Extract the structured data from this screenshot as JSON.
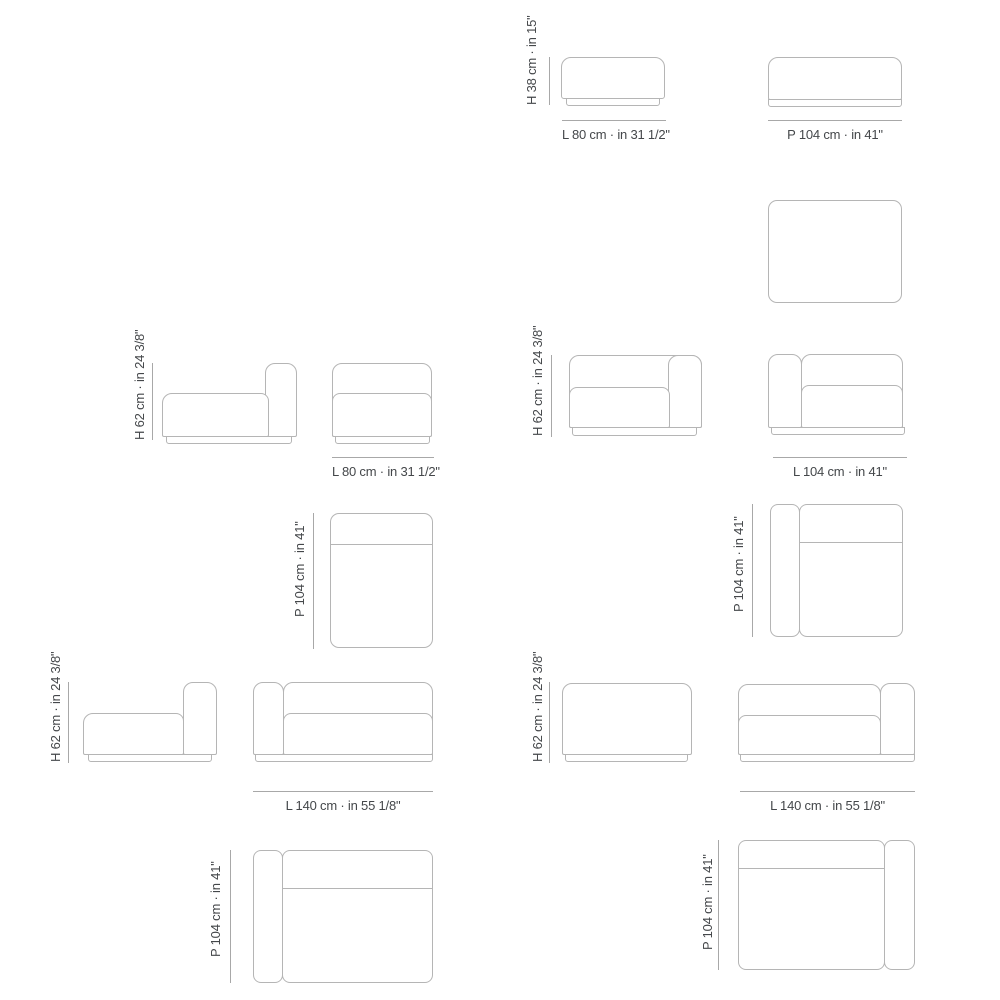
{
  "colors": {
    "background": "#ffffff",
    "drawing_line": "#b5b5b5",
    "dimension_line": "#a8a8a8",
    "label_text": "#44474a"
  },
  "modules": [
    {
      "height_label": "H 38 cm · in 15\"",
      "length_label": "L 80 cm · in 31 1/2\"",
      "depth_label": "P 104 cm · in 41\""
    },
    {
      "height_label": "H 62 cm · in 24 3/8\"",
      "length_label": "L 80 cm · in 31 1/2\"",
      "depth_label": "P 104 cm · in 41\""
    },
    {
      "height_label": "H 62 cm · in 24 3/8\"",
      "length_label": "L 104 cm · in 41\"",
      "depth_label": "P 104 cm · in 41\""
    },
    {
      "height_label": "H 62 cm · in 24 3/8\"",
      "length_label": "L 140 cm · in 55 1/8\"",
      "depth_label": "P 104 cm · in 41\""
    },
    {
      "height_label": "H 62 cm · in 24 3/8\"",
      "length_label": "L 140 cm · in 55 1/8\"",
      "depth_label": "P 104 cm · in 41\""
    }
  ]
}
